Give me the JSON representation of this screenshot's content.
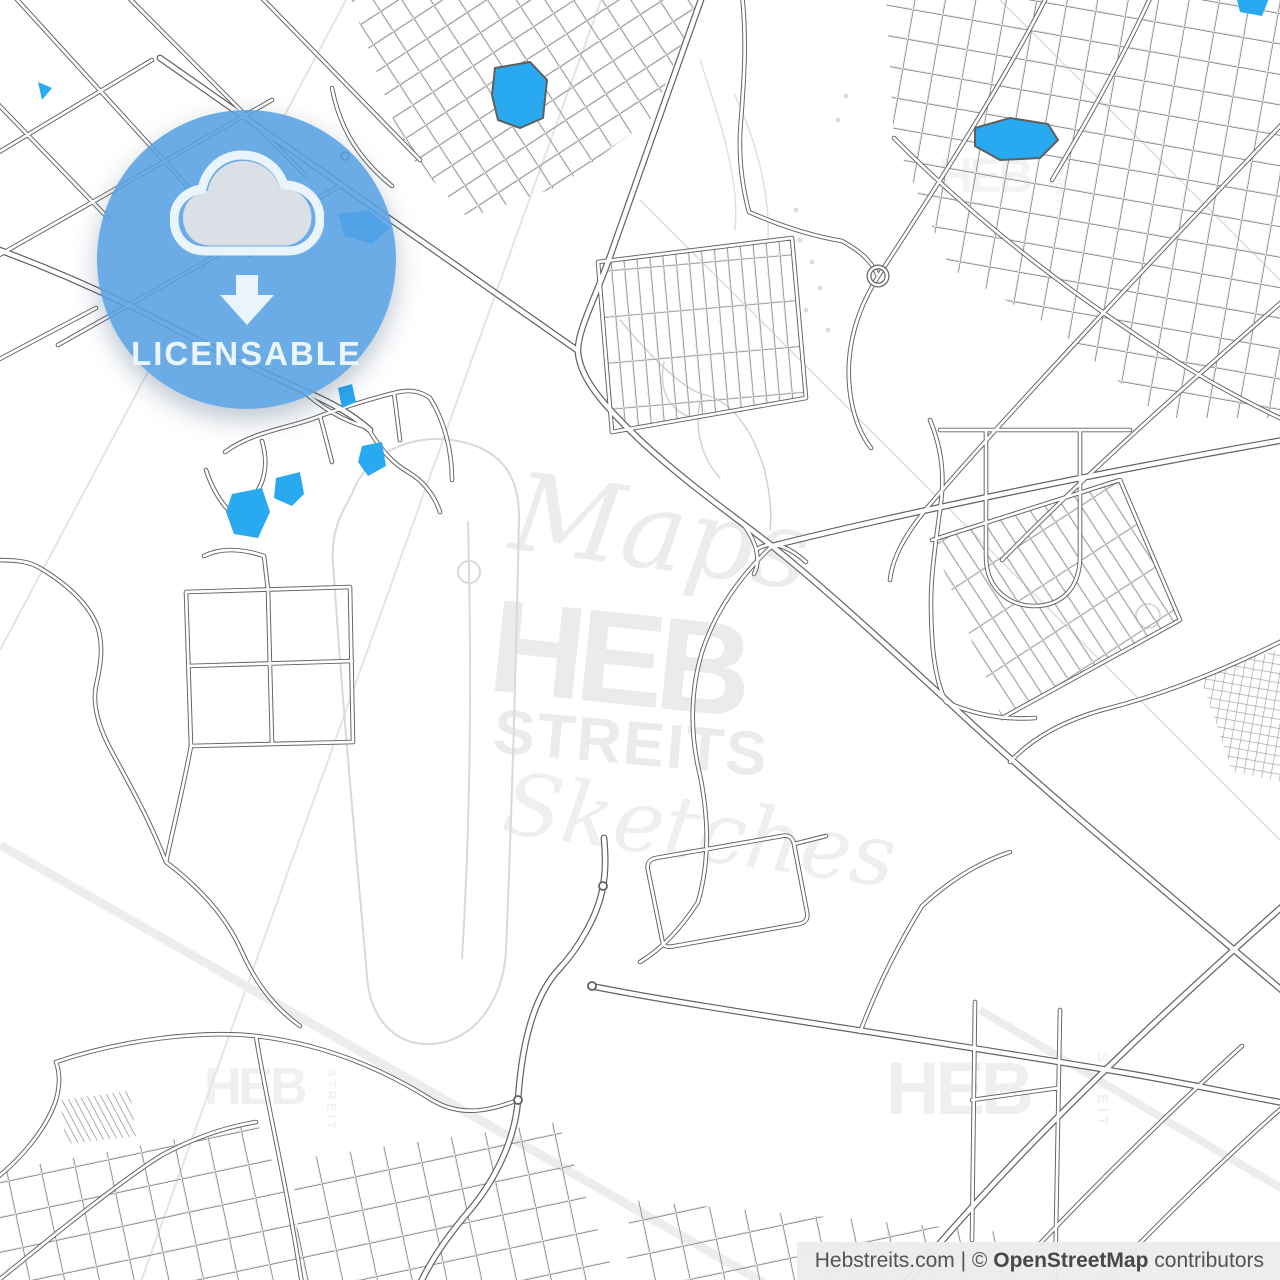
{
  "badge": {
    "label": "LICENSABLE",
    "icon": "cloud-download-icon",
    "circle_color": "#57A1E4",
    "label_color": "#EAF5FE",
    "icon_outline_color": "#E9F4FD",
    "icon_fill_color": "#E2E3E6"
  },
  "watermarks": {
    "center": {
      "script_top": "Maps",
      "brand": "HEB",
      "sub": "STREITS",
      "script_bottom": "Sketches"
    },
    "corner_brand": "HEB",
    "corner_vertical": "STREIT",
    "color": "#ededed"
  },
  "attribution": {
    "site": "Hebstreits.com",
    "separator": " | ",
    "copyright_symbol": "© ",
    "osm": "OpenStreetMap",
    "suffix": " contributors"
  },
  "colors": {
    "water": "#29A9F0",
    "road_casing": "#616161",
    "road_fill": "#ffffff",
    "light_line": "#d9d9d9",
    "boundary_line": "#e4e4e4",
    "background": "#ffffff"
  }
}
